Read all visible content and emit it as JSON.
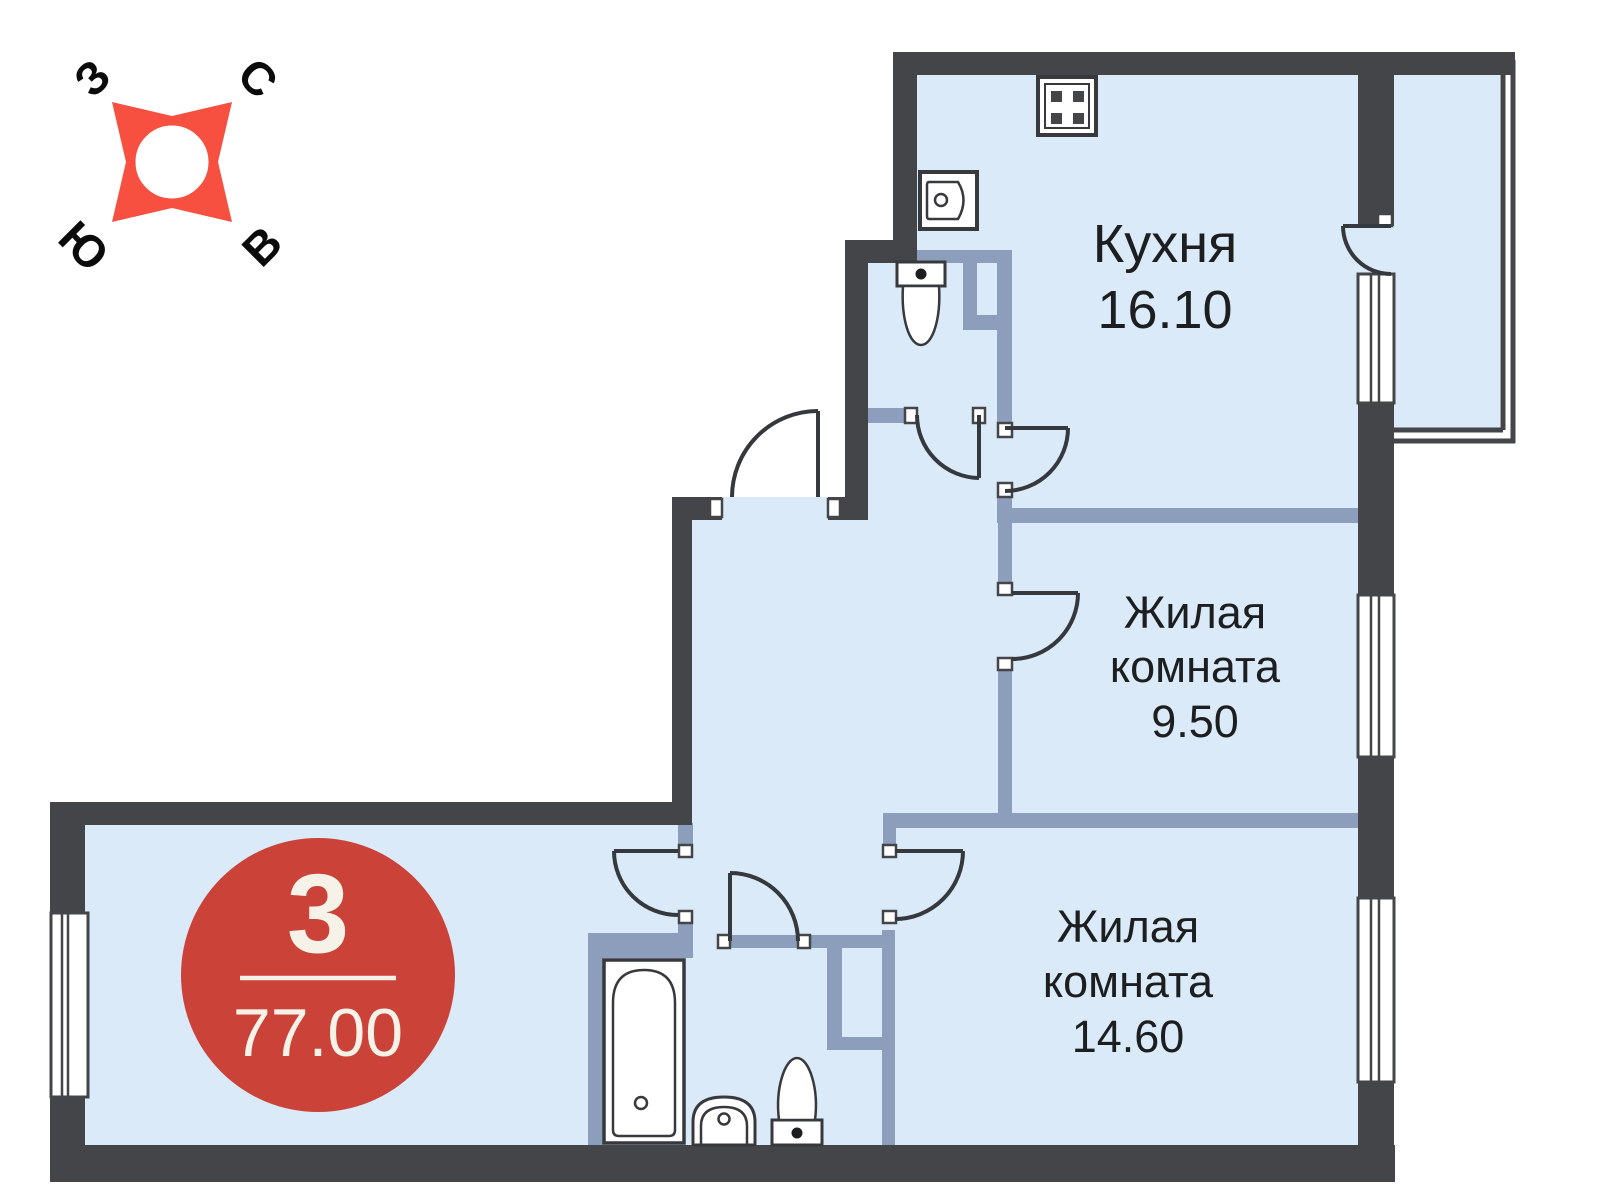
{
  "plan": {
    "badge": {
      "rooms_count": "3",
      "total_area": "77.00"
    },
    "rooms": {
      "kitchen": {
        "name": "Кухня",
        "area": "16.10"
      },
      "living_room_1": {
        "name_line1": "Жилая",
        "name_line2": "комната",
        "area": "9.50"
      },
      "living_room_2": {
        "name_line1": "Жилая",
        "name_line2": "комната",
        "area": "14.60"
      }
    },
    "compass": {
      "west_label": "З",
      "north_label": "С",
      "south_label": "Ю",
      "east_label": "В"
    },
    "fixtures": [
      "stove-icon",
      "kitchen-sink-icon",
      "wc-toilet-icon",
      "bathtub-icon",
      "washbasin-icon",
      "bathroom-toilet-icon"
    ],
    "colors": {
      "wall_dark": "#434548",
      "wall_partition": "#8c9ebc",
      "room_fill": "#daeaf8",
      "badge_red": "#cb4239",
      "compass_red": "#f75040",
      "badge_text": "#f6f2e7"
    }
  }
}
